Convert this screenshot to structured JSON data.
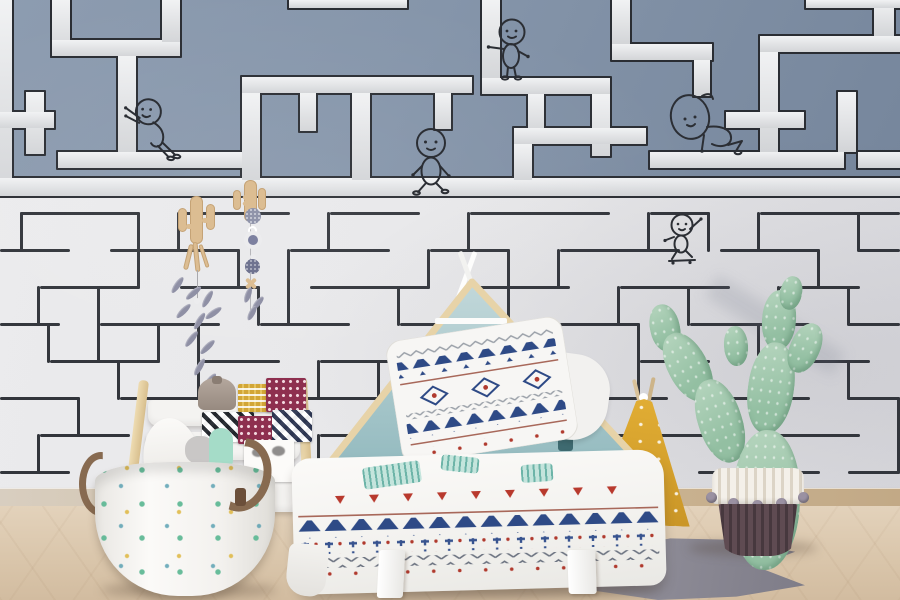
{
  "scene": {
    "title": "kids-bedroom-maze-wallpaper",
    "description": "Children's bedroom with a two-tone maze wallpaper (blue upper band with white corridors, white lower band with thin dark lines), doodle stick figures on the maze, a house-frame bed, sling bookshelf, cactus-print storage basket, potted prickly-pear cactus, yellow teepee cushion and a grey fishtail rug on a light wood floor."
  },
  "palette": {
    "wall_upper_blue": "#8595aa",
    "maze_channel_white": "#e3e5e8",
    "maze_outline_dark": "#2a2d33",
    "wall_lower_white": "#e7e7e9",
    "maze_line_dark": "#32353b",
    "wood_light": "#e7d3a8",
    "headboard_teal": "#a7c7ca",
    "pillow_navy": "#2e4a86",
    "accent_red": "#b03a2e",
    "mint_print": "#bfe3da",
    "teepee_yellow": "#d9a732",
    "rug_grey": "#8d8b95",
    "floor_wood": "#d9c5aa",
    "basket_leather": "#876a50",
    "cactus_green": "#9fc6ab",
    "pot_dark": "#5f4b52",
    "pompom_grey": "#9a91a2"
  },
  "wallpaper": {
    "upper_maze": {
      "segments": [
        {
          "x": 0,
          "y": 0,
          "w": 12,
          "h": 196
        },
        {
          "x": 0,
          "y": 178,
          "w": 900,
          "h": 18
        },
        {
          "x": 52,
          "y": 0,
          "w": 18,
          "h": 56
        },
        {
          "x": 52,
          "y": 40,
          "w": 128,
          "h": 16
        },
        {
          "x": 162,
          "y": 0,
          "w": 18,
          "h": 42
        },
        {
          "x": 118,
          "y": 56,
          "w": 18,
          "h": 98
        },
        {
          "x": 26,
          "y": 92,
          "w": 18,
          "h": 62
        },
        {
          "x": 0,
          "y": 112,
          "w": 54,
          "h": 16
        },
        {
          "x": 58,
          "y": 152,
          "w": 202,
          "h": 16
        },
        {
          "x": 242,
          "y": 77,
          "w": 230,
          "h": 16
        },
        {
          "x": 242,
          "y": 93,
          "w": 18,
          "h": 87
        },
        {
          "x": 300,
          "y": 93,
          "w": 16,
          "h": 38
        },
        {
          "x": 352,
          "y": 93,
          "w": 18,
          "h": 87
        },
        {
          "x": 435,
          "y": 93,
          "w": 16,
          "h": 36
        },
        {
          "x": 289,
          "y": 0,
          "w": 118,
          "h": 8
        },
        {
          "x": 482,
          "y": 0,
          "w": 18,
          "h": 80
        },
        {
          "x": 482,
          "y": 78,
          "w": 128,
          "h": 16
        },
        {
          "x": 528,
          "y": 94,
          "w": 16,
          "h": 38
        },
        {
          "x": 592,
          "y": 94,
          "w": 18,
          "h": 62
        },
        {
          "x": 612,
          "y": 0,
          "w": 18,
          "h": 44
        },
        {
          "x": 612,
          "y": 44,
          "w": 100,
          "h": 16
        },
        {
          "x": 694,
          "y": 60,
          "w": 16,
          "h": 36
        },
        {
          "x": 514,
          "y": 128,
          "w": 132,
          "h": 16
        },
        {
          "x": 514,
          "y": 144,
          "w": 18,
          "h": 36
        },
        {
          "x": 650,
          "y": 152,
          "w": 194,
          "h": 16
        },
        {
          "x": 760,
          "y": 36,
          "w": 140,
          "h": 16
        },
        {
          "x": 760,
          "y": 52,
          "w": 18,
          "h": 100
        },
        {
          "x": 726,
          "y": 112,
          "w": 78,
          "h": 16
        },
        {
          "x": 838,
          "y": 92,
          "w": 18,
          "h": 60
        },
        {
          "x": 858,
          "y": 152,
          "w": 42,
          "h": 16
        },
        {
          "x": 874,
          "y": 0,
          "w": 20,
          "h": 36
        },
        {
          "x": 806,
          "y": 0,
          "w": 94,
          "h": 8
        }
      ]
    },
    "lower_maze": {
      "lines": [
        {
          "x": 20,
          "y": 212,
          "w": 120,
          "h": 3
        },
        {
          "x": 180,
          "y": 212,
          "w": 110,
          "h": 3
        },
        {
          "x": 330,
          "y": 212,
          "w": 90,
          "h": 3
        },
        {
          "x": 470,
          "y": 212,
          "w": 140,
          "h": 3
        },
        {
          "x": 650,
          "y": 212,
          "w": 60,
          "h": 3
        },
        {
          "x": 760,
          "y": 212,
          "w": 140,
          "h": 3
        },
        {
          "x": 0,
          "y": 249,
          "w": 70,
          "h": 3
        },
        {
          "x": 110,
          "y": 249,
          "w": 130,
          "h": 3
        },
        {
          "x": 290,
          "y": 249,
          "w": 100,
          "h": 3
        },
        {
          "x": 430,
          "y": 249,
          "w": 80,
          "h": 3
        },
        {
          "x": 560,
          "y": 249,
          "w": 120,
          "h": 3
        },
        {
          "x": 720,
          "y": 249,
          "w": 100,
          "h": 3
        },
        {
          "x": 858,
          "y": 249,
          "w": 42,
          "h": 3
        },
        {
          "x": 40,
          "y": 286,
          "w": 100,
          "h": 3
        },
        {
          "x": 180,
          "y": 286,
          "w": 80,
          "h": 3
        },
        {
          "x": 310,
          "y": 286,
          "w": 120,
          "h": 3
        },
        {
          "x": 480,
          "y": 286,
          "w": 90,
          "h": 3
        },
        {
          "x": 620,
          "y": 286,
          "w": 110,
          "h": 3
        },
        {
          "x": 780,
          "y": 286,
          "w": 80,
          "h": 3
        },
        {
          "x": 0,
          "y": 323,
          "w": 60,
          "h": 3
        },
        {
          "x": 100,
          "y": 323,
          "w": 120,
          "h": 3
        },
        {
          "x": 260,
          "y": 323,
          "w": 90,
          "h": 3
        },
        {
          "x": 400,
          "y": 323,
          "w": 110,
          "h": 3
        },
        {
          "x": 560,
          "y": 323,
          "w": 80,
          "h": 3
        },
        {
          "x": 690,
          "y": 323,
          "w": 120,
          "h": 3
        },
        {
          "x": 848,
          "y": 323,
          "w": 52,
          "h": 3
        },
        {
          "x": 50,
          "y": 360,
          "w": 110,
          "h": 3
        },
        {
          "x": 200,
          "y": 360,
          "w": 80,
          "h": 3
        },
        {
          "x": 320,
          "y": 360,
          "w": 100,
          "h": 3
        },
        {
          "x": 470,
          "y": 360,
          "w": 120,
          "h": 3
        },
        {
          "x": 640,
          "y": 360,
          "w": 70,
          "h": 3
        },
        {
          "x": 758,
          "y": 360,
          "w": 112,
          "h": 3
        },
        {
          "x": 0,
          "y": 397,
          "w": 80,
          "h": 3
        },
        {
          "x": 120,
          "y": 397,
          "w": 100,
          "h": 3
        },
        {
          "x": 260,
          "y": 397,
          "w": 120,
          "h": 3
        },
        {
          "x": 430,
          "y": 397,
          "w": 80,
          "h": 3
        },
        {
          "x": 558,
          "y": 397,
          "w": 110,
          "h": 3
        },
        {
          "x": 718,
          "y": 397,
          "w": 92,
          "h": 3
        },
        {
          "x": 848,
          "y": 397,
          "w": 52,
          "h": 3
        },
        {
          "x": 40,
          "y": 434,
          "w": 90,
          "h": 3
        },
        {
          "x": 170,
          "y": 434,
          "w": 110,
          "h": 3
        },
        {
          "x": 320,
          "y": 434,
          "w": 80,
          "h": 3
        },
        {
          "x": 450,
          "y": 434,
          "w": 120,
          "h": 3
        },
        {
          "x": 618,
          "y": 434,
          "w": 90,
          "h": 3
        },
        {
          "x": 758,
          "y": 434,
          "w": 102,
          "h": 3
        },
        {
          "x": 0,
          "y": 471,
          "w": 70,
          "h": 3
        },
        {
          "x": 110,
          "y": 471,
          "w": 120,
          "h": 3
        },
        {
          "x": 270,
          "y": 471,
          "w": 90,
          "h": 3
        },
        {
          "x": 408,
          "y": 471,
          "w": 110,
          "h": 3
        },
        {
          "x": 568,
          "y": 471,
          "w": 80,
          "h": 3
        },
        {
          "x": 698,
          "y": 471,
          "w": 122,
          "h": 3
        },
        {
          "x": 848,
          "y": 471,
          "w": 52,
          "h": 3
        },
        {
          "x": 20,
          "y": 212,
          "w": 3,
          "h": 40
        },
        {
          "x": 137,
          "y": 212,
          "w": 3,
          "h": 77
        },
        {
          "x": 177,
          "y": 212,
          "w": 3,
          "h": 40
        },
        {
          "x": 237,
          "y": 249,
          "w": 3,
          "h": 40
        },
        {
          "x": 287,
          "y": 249,
          "w": 3,
          "h": 77
        },
        {
          "x": 327,
          "y": 212,
          "w": 3,
          "h": 40
        },
        {
          "x": 427,
          "y": 249,
          "w": 3,
          "h": 40
        },
        {
          "x": 467,
          "y": 212,
          "w": 3,
          "h": 40
        },
        {
          "x": 507,
          "y": 249,
          "w": 3,
          "h": 77
        },
        {
          "x": 557,
          "y": 249,
          "w": 3,
          "h": 40
        },
        {
          "x": 647,
          "y": 212,
          "w": 3,
          "h": 40
        },
        {
          "x": 707,
          "y": 212,
          "w": 3,
          "h": 40
        },
        {
          "x": 757,
          "y": 212,
          "w": 3,
          "h": 40
        },
        {
          "x": 817,
          "y": 249,
          "w": 3,
          "h": 40
        },
        {
          "x": 857,
          "y": 212,
          "w": 3,
          "h": 40
        },
        {
          "x": 37,
          "y": 286,
          "w": 3,
          "h": 40
        },
        {
          "x": 97,
          "y": 286,
          "w": 3,
          "h": 77
        },
        {
          "x": 157,
          "y": 323,
          "w": 3,
          "h": 40
        },
        {
          "x": 257,
          "y": 286,
          "w": 3,
          "h": 40
        },
        {
          "x": 397,
          "y": 286,
          "w": 3,
          "h": 40
        },
        {
          "x": 477,
          "y": 286,
          "w": 3,
          "h": 77
        },
        {
          "x": 617,
          "y": 286,
          "w": 3,
          "h": 40
        },
        {
          "x": 687,
          "y": 286,
          "w": 3,
          "h": 40
        },
        {
          "x": 777,
          "y": 286,
          "w": 3,
          "h": 40
        },
        {
          "x": 847,
          "y": 286,
          "w": 3,
          "h": 40
        },
        {
          "x": 47,
          "y": 323,
          "w": 3,
          "h": 40
        },
        {
          "x": 197,
          "y": 323,
          "w": 3,
          "h": 77
        },
        {
          "x": 317,
          "y": 360,
          "w": 3,
          "h": 40
        },
        {
          "x": 467,
          "y": 360,
          "w": 3,
          "h": 40
        },
        {
          "x": 637,
          "y": 323,
          "w": 3,
          "h": 77
        },
        {
          "x": 757,
          "y": 323,
          "w": 3,
          "h": 40
        },
        {
          "x": 77,
          "y": 397,
          "w": 3,
          "h": 40
        },
        {
          "x": 117,
          "y": 360,
          "w": 3,
          "h": 40
        },
        {
          "x": 257,
          "y": 397,
          "w": 3,
          "h": 77
        },
        {
          "x": 377,
          "y": 360,
          "w": 3,
          "h": 40
        },
        {
          "x": 427,
          "y": 397,
          "w": 3,
          "h": 40
        },
        {
          "x": 557,
          "y": 397,
          "w": 3,
          "h": 40
        },
        {
          "x": 717,
          "y": 397,
          "w": 3,
          "h": 40
        },
        {
          "x": 847,
          "y": 360,
          "w": 3,
          "h": 40
        },
        {
          "x": 37,
          "y": 434,
          "w": 3,
          "h": 40
        },
        {
          "x": 167,
          "y": 434,
          "w": 3,
          "h": 40
        },
        {
          "x": 317,
          "y": 434,
          "w": 3,
          "h": 40
        },
        {
          "x": 447,
          "y": 434,
          "w": 3,
          "h": 40
        },
        {
          "x": 617,
          "y": 434,
          "w": 3,
          "h": 40
        },
        {
          "x": 757,
          "y": 434,
          "w": 3,
          "h": 40
        },
        {
          "x": 897,
          "y": 397,
          "w": 3,
          "h": 77
        }
      ]
    },
    "figures": [
      {
        "id": "fig-pushing",
        "x": 120,
        "y": 95,
        "pose": "leaning forward pushing a maze wall"
      },
      {
        "id": "fig-standing",
        "x": 486,
        "y": 17,
        "pose": "standing on a ledge, arm out"
      },
      {
        "id": "fig-walking",
        "x": 405,
        "y": 126,
        "pose": "strolling along the corridor"
      },
      {
        "id": "fig-resting",
        "x": 662,
        "y": 83,
        "pose": "big-headed figure slumped on a ledge"
      },
      {
        "id": "fig-skating",
        "x": 662,
        "y": 213,
        "pose": "waving figure on a tiny skateboard"
      }
    ]
  },
  "furniture": {
    "bed": {
      "style": "house-frame headboard",
      "wood": "#e7d3a8",
      "interior": "#a7c7ca",
      "shelf": "white",
      "pillow": "white with navy triangles, diamonds and zigzag rows",
      "blanket": "white with navy triangle border, plus-sign row, zigzag hem, red mini-triangles and mint prints"
    },
    "bookshelf": {
      "style": "wood sling book rack",
      "items": [
        "grey drawstring pouch",
        "yellow checked card",
        "maroon dotted card",
        "black-white diamond card",
        "navy diamond card",
        "panda face card",
        "mint cactus plushes",
        "script on front sling (illegible)"
      ]
    },
    "basket": {
      "style": "fabric storage basket with cactus print and leather handles",
      "contents": [
        "white plush",
        "grey plush",
        "mint cactus plush"
      ]
    },
    "plant": {
      "style": "prickly-pear cactus in two-tone woven basket pot with grey pompoms"
    },
    "teepee_cushion": {
      "color": "#d9a732",
      "details": "white dots, white door, twin poles"
    },
    "rug": {
      "shape": "grey fishtail"
    },
    "hanging_decor": [
      "wooden cactus cutout with stick-and-feather garland",
      "wooden cactus cutout with bead-and-ring garland"
    ]
  }
}
